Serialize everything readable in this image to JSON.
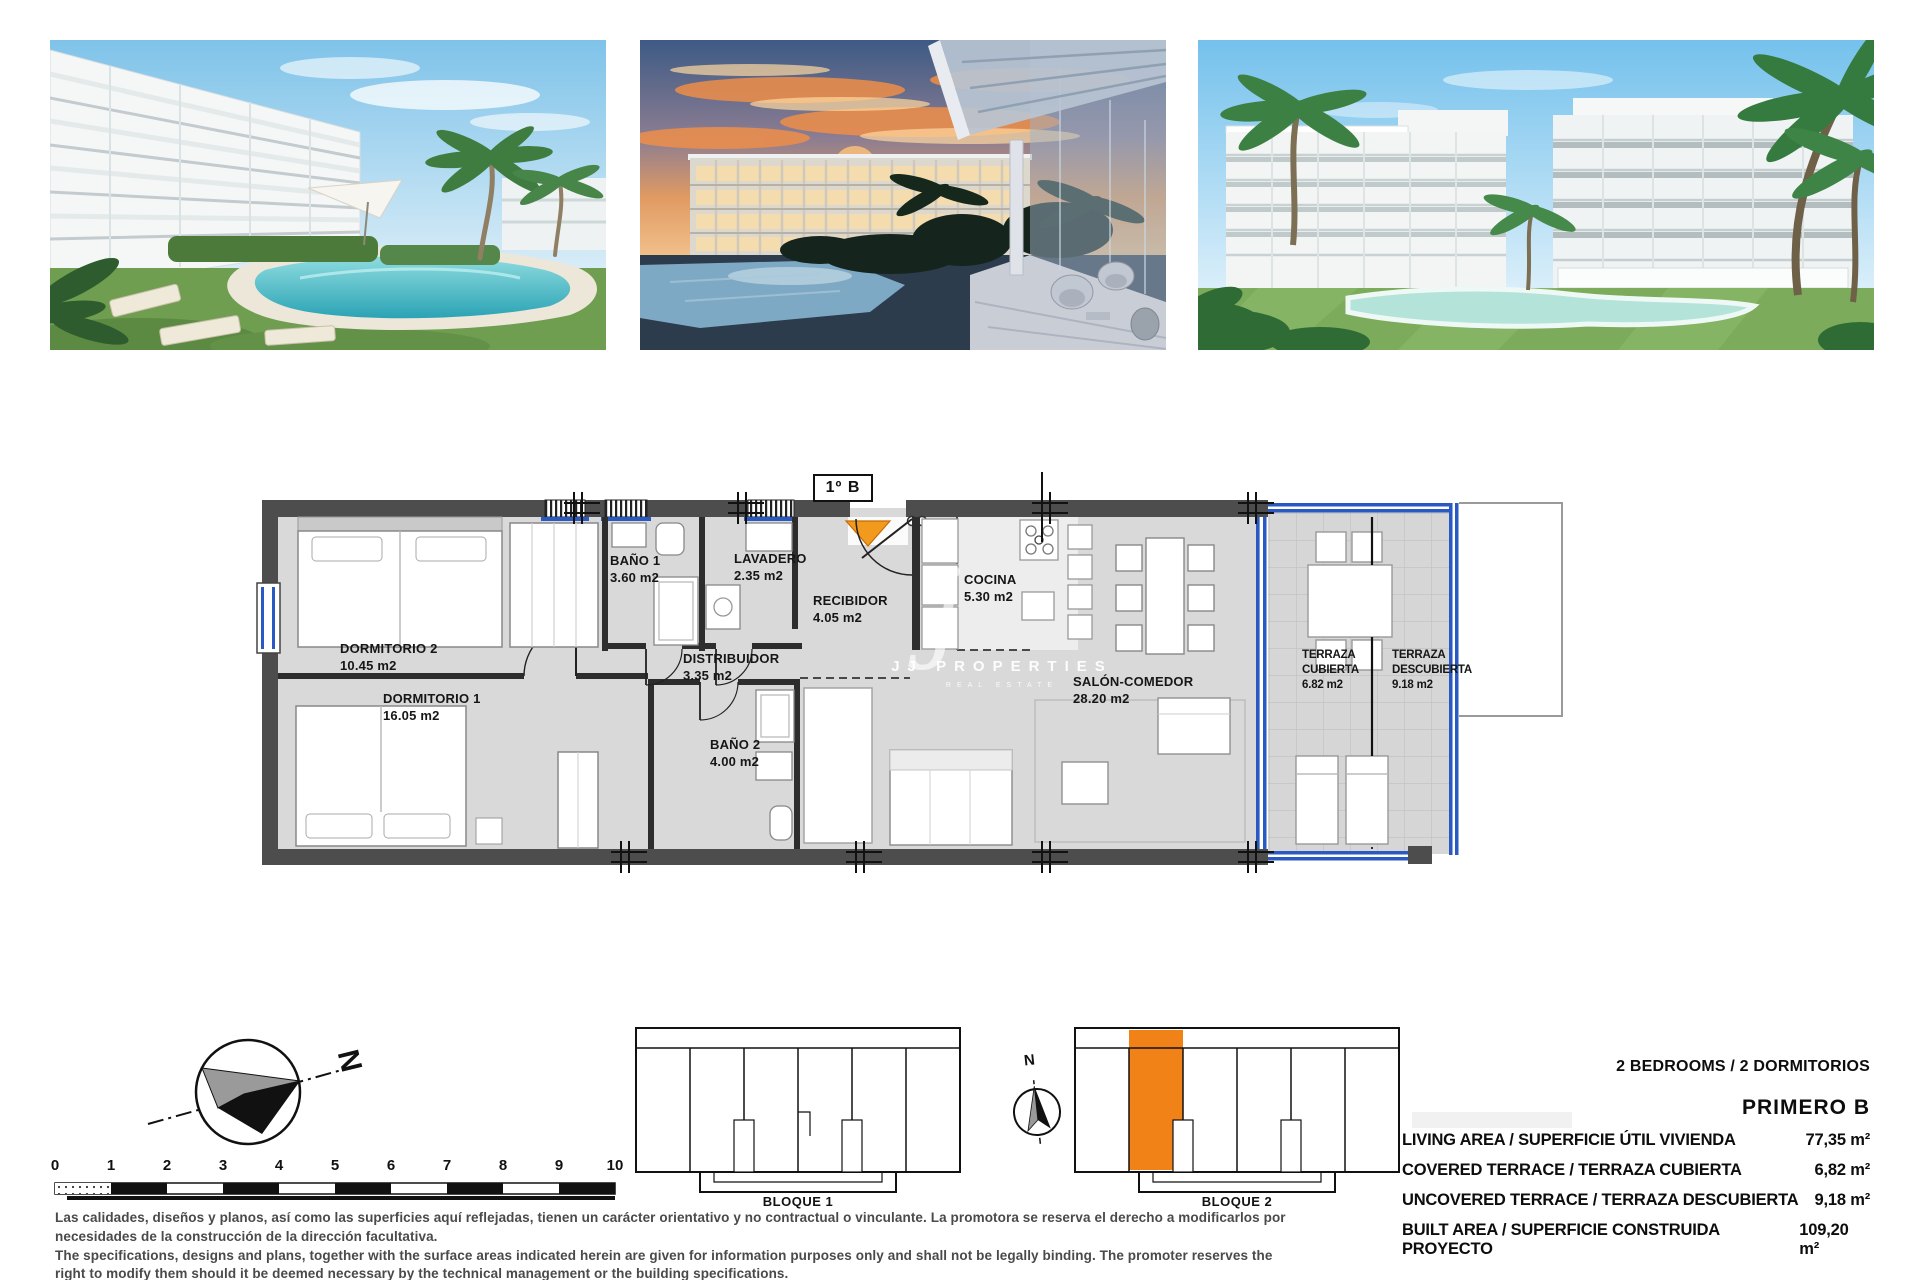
{
  "plan": {
    "unit_badge": "1º B",
    "rooms": {
      "dorm2": {
        "name": "DORMITORIO 2",
        "area": "10.45 m2"
      },
      "dorm1": {
        "name": "DORMITORIO 1",
        "area": "16.05 m2"
      },
      "bano1": {
        "name": "BAÑO 1",
        "area": "3.60 m2"
      },
      "lavadero": {
        "name": "LAVADERO",
        "area": "2.35 m2"
      },
      "recibidor": {
        "name": "RECIBIDOR",
        "area": "4.05 m2"
      },
      "distribuidor": {
        "name": "DISTRIBUIDOR",
        "area": "3.35 m2"
      },
      "bano2": {
        "name": "BAÑO 2",
        "area": "4.00 m2"
      },
      "cocina": {
        "name": "COCINA",
        "area": "5.30 m2"
      },
      "salon": {
        "name": "SALÓN-COMEDOR",
        "area": "28.20 m2"
      },
      "terraza_cubierta": {
        "line1": "TERRAZA",
        "line2": "CUBIERTA",
        "area": "6.82 m2"
      },
      "terraza_descubierta": {
        "line1": "TERRAZA",
        "line2": "DESCUBIERTA",
        "area": "9.18 m2"
      }
    },
    "watermark": {
      "brand": "JJ PROPERTIES",
      "tagline": "REAL ESTATE",
      "logo_glyph": "j"
    }
  },
  "site": {
    "block1_label": "BLOQUE 1",
    "block2_label": "BLOQUE 2",
    "north_label": "N",
    "mini_north_label": "N"
  },
  "scalebar": {
    "ticks": [
      "0",
      "1",
      "2",
      "3",
      "4",
      "5",
      "6",
      "7",
      "8",
      "9",
      "10"
    ]
  },
  "specs": {
    "type_line": "2 BEDROOMS / 2 DORMITORIOS",
    "floor_label": "PRIMERO B",
    "rows": [
      {
        "label": "LIVING AREA / SUPERFICIE ÚTIL VIVIENDA",
        "value": "77,35 m²"
      },
      {
        "label": "COVERED TERRACE / TERRAZA CUBIERTA",
        "value": "6,82 m²"
      },
      {
        "label": "UNCOVERED TERRACE / TERRAZA DESCUBIERTA",
        "value": "9,18 m²"
      },
      {
        "label": "BUILT AREA / SUPERFICIE CONSTRUIDA PROYECTO",
        "value": "109,20 m²"
      }
    ]
  },
  "disclaimer": {
    "lines": [
      "Las calidades, diseños y planos, así como las superficies aquí reflejadas, tienen un carácter orientativo y no contractual o vinculante. La promotora se reserva el derecho a modificarlos por",
      "necesidades de la construcción de la dirección facultativa.",
      "The specifications, designs and plans, together with the surface areas indicated herein are given for information purposes only and shall not be legally binding. The promoter reserves the",
      "right to modify them should it be deemed necessary by the technical management or the building specifications."
    ]
  },
  "colors": {
    "accent_orange": "#f08218",
    "glass_blue": "#2b59c3",
    "wall_dark": "#4d4d4d"
  }
}
